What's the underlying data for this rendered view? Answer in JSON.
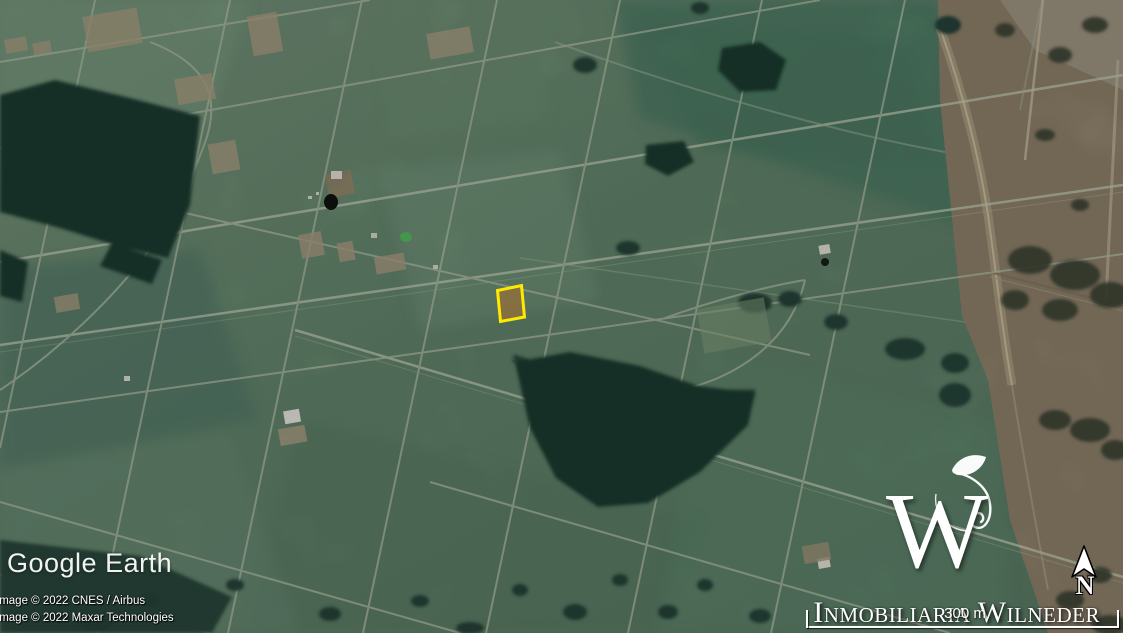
{
  "watermark": {
    "logo_text": "Google Earth"
  },
  "copyright": {
    "line1": "Image © 2022 CNES / Airbus",
    "line2": "Image © 2022 Maxar Technologies"
  },
  "brand": {
    "logo_letter": "W",
    "name": "Inmobiliaria Wilneder",
    "flourish_icon": "leaf-flourish-icon"
  },
  "compass": {
    "label": "N",
    "icon": "north-arrow-icon"
  },
  "scale_bar": {
    "label": "300 m"
  },
  "map": {
    "imagery_type": "satellite",
    "highlighted_plot": {
      "outline_color": "#FFE900",
      "fill_color": "#8A6F3E"
    }
  }
}
